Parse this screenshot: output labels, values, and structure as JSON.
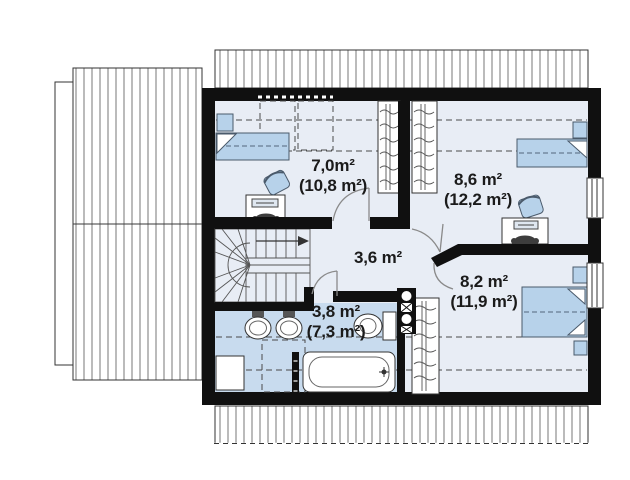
{
  "plan": {
    "drawing_type": "attic floor plan",
    "rooms": [
      {
        "id": "bedroom-top-left",
        "area": "7,0m²",
        "area_total": "(10,8 m²)"
      },
      {
        "id": "bedroom-top-right",
        "area": "8,6 m²",
        "area_total": "(12,2 m²)"
      },
      {
        "id": "hall",
        "area": "3,6 m²"
      },
      {
        "id": "bathroom",
        "area": "3,8 m²",
        "area_total": "(7,3 m²)"
      },
      {
        "id": "bedroom-bottom-right",
        "area": "8,2 m²",
        "area_total": "(11,9 m²)"
      }
    ],
    "colors": {
      "wall": "#101010",
      "floor": "#e8edf5",
      "bathroom_floor": "#c8dbee",
      "furniture": "#b7d2ea",
      "line": "#3a3a3a",
      "text": "#1b1b1b"
    },
    "symbols": [
      "single-bed",
      "double-bed",
      "nightstand",
      "wardrobe",
      "desk",
      "desk-chair",
      "office-chair",
      "sink",
      "toilet",
      "bathtub",
      "winder-stairs",
      "up-arrow",
      "door-swing",
      "window",
      "chimney-flue",
      "radiator",
      "roof-hatch",
      "skylight"
    ]
  }
}
